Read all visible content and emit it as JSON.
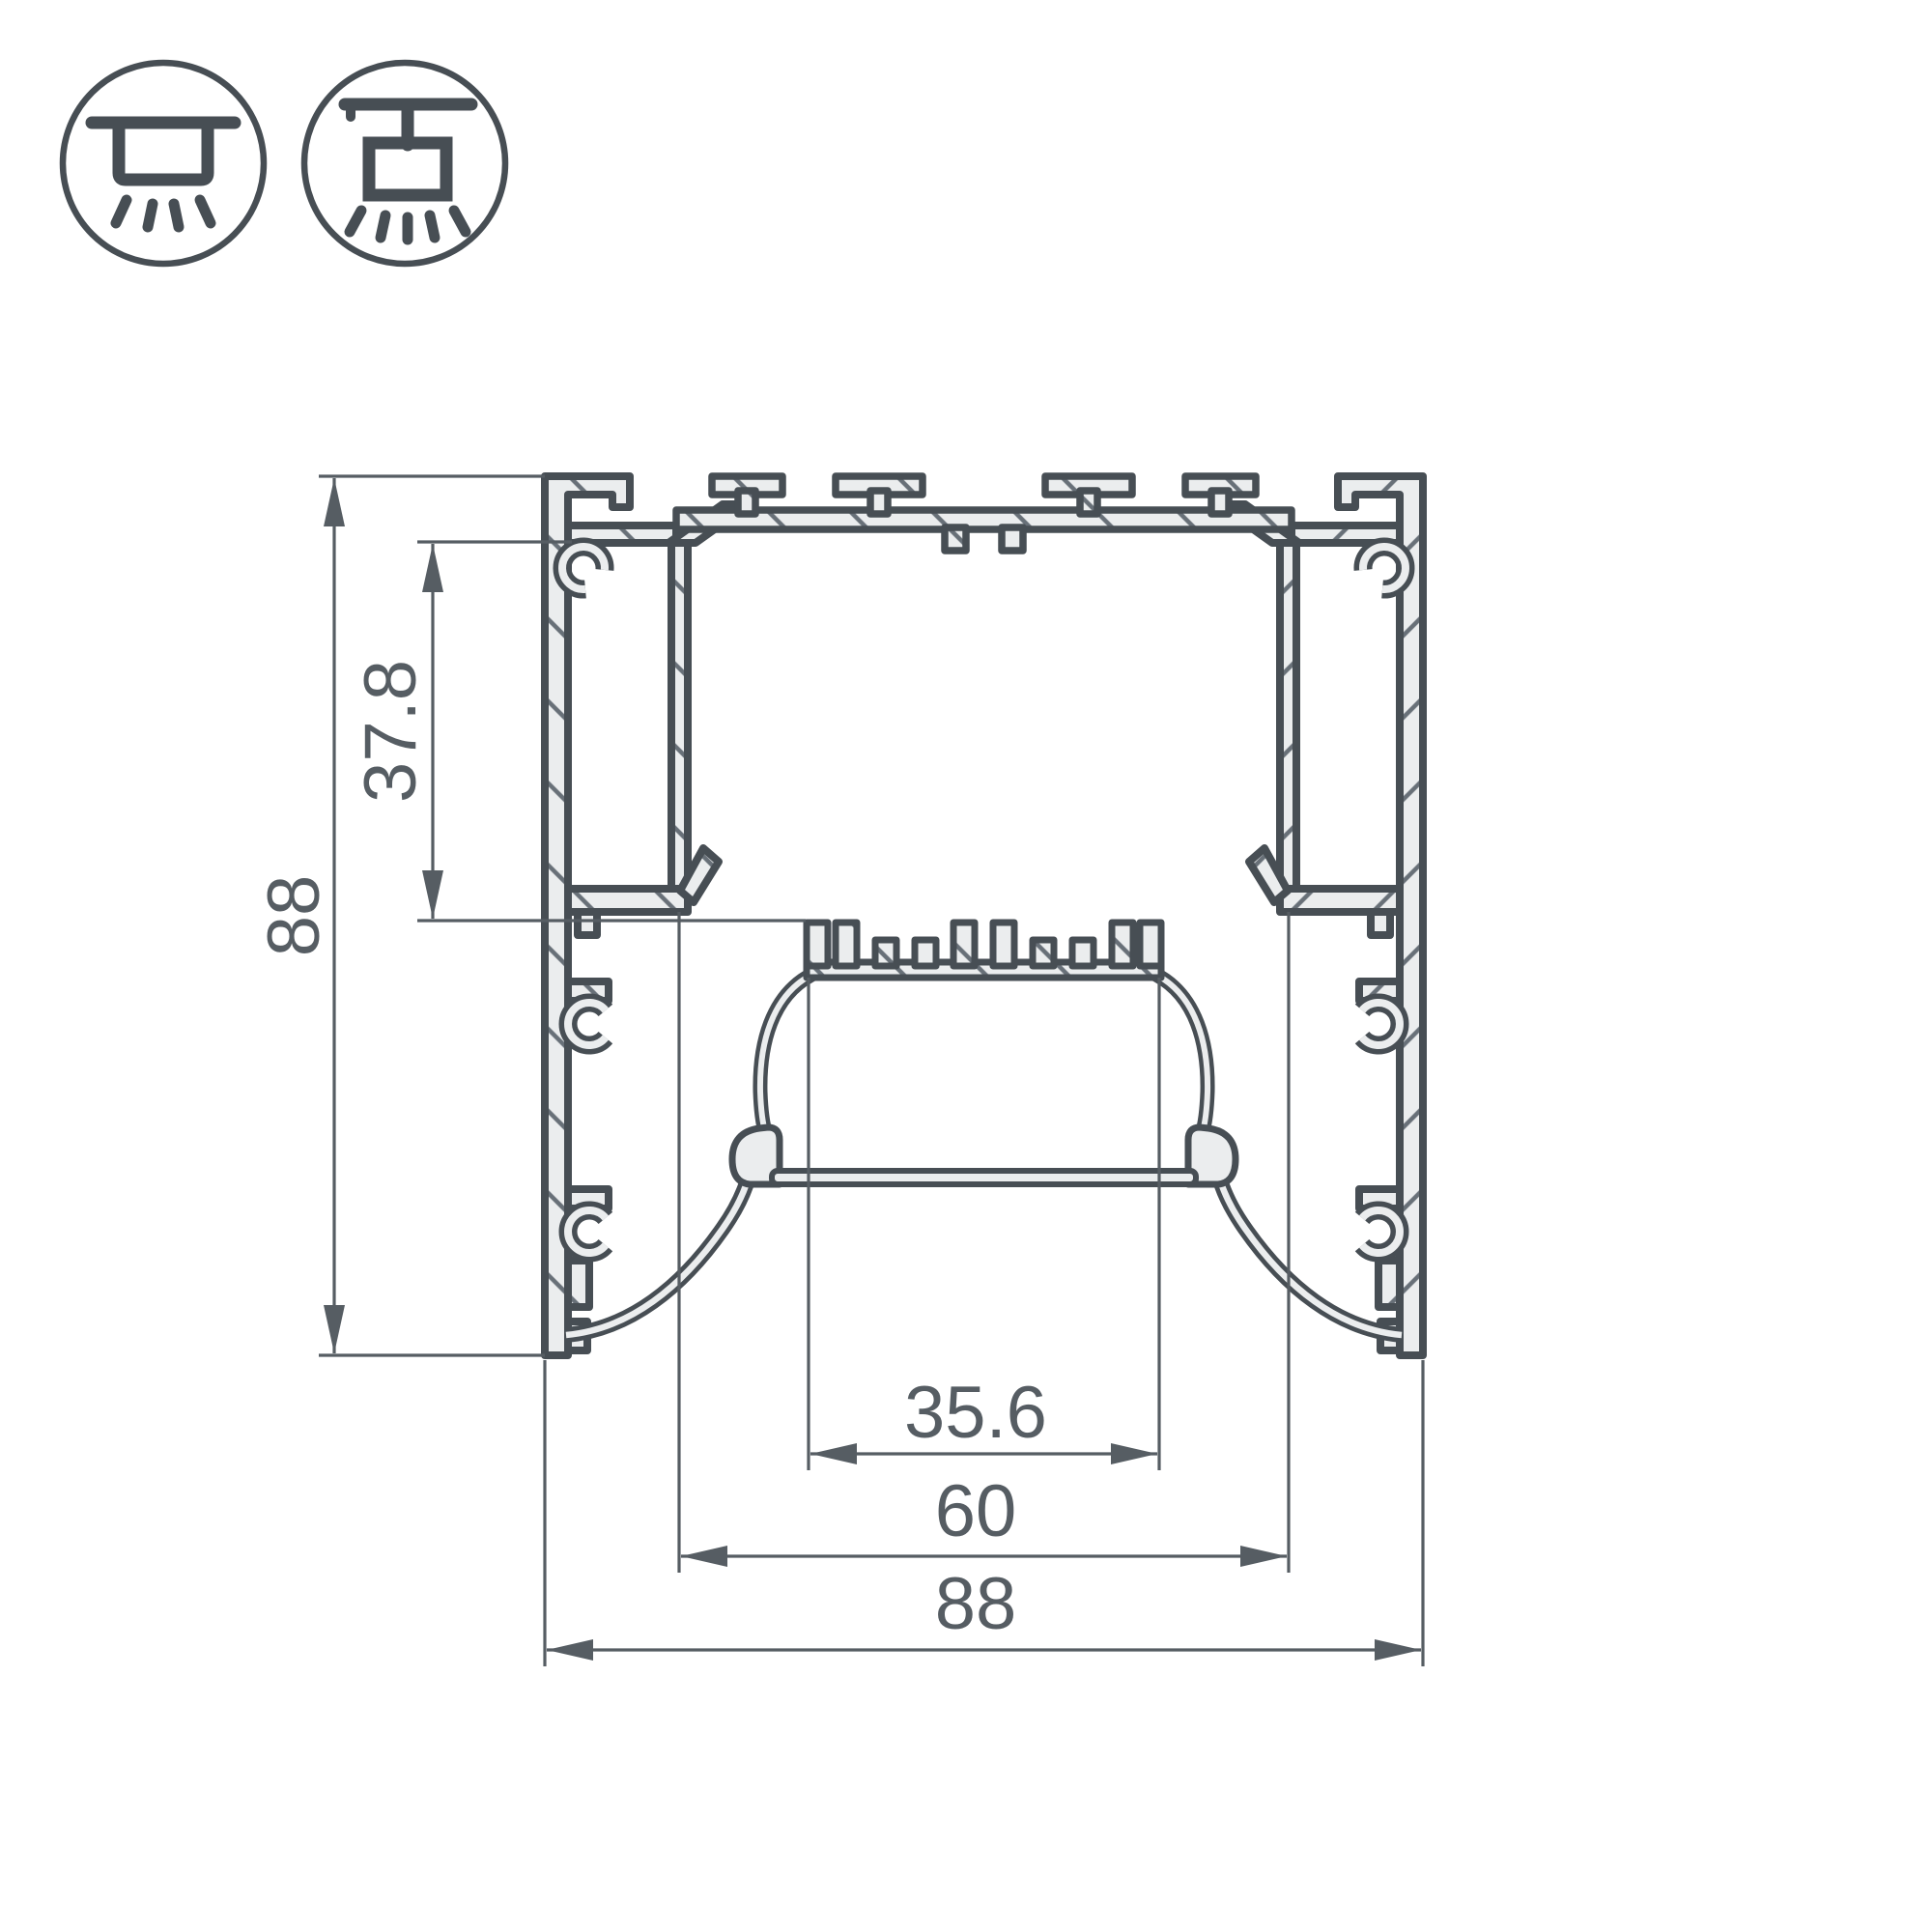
{
  "drawing": {
    "kind": "technical cross-section of an aluminium LED lighting profile",
    "mount_icons": [
      {
        "name": "surface-mount-luminaire-icon"
      },
      {
        "name": "pendant-mount-luminaire-icon"
      }
    ],
    "dimensions": {
      "overall_height": "88",
      "cavity_height": "37.8",
      "lens_width": "35.6",
      "opening_width": "60",
      "overall_width": "88"
    },
    "colors": {
      "outline": "#474e54",
      "fill": "#ebedee",
      "hatch": "#687078",
      "dimension": "#565d63",
      "background": "#ffffff"
    }
  }
}
